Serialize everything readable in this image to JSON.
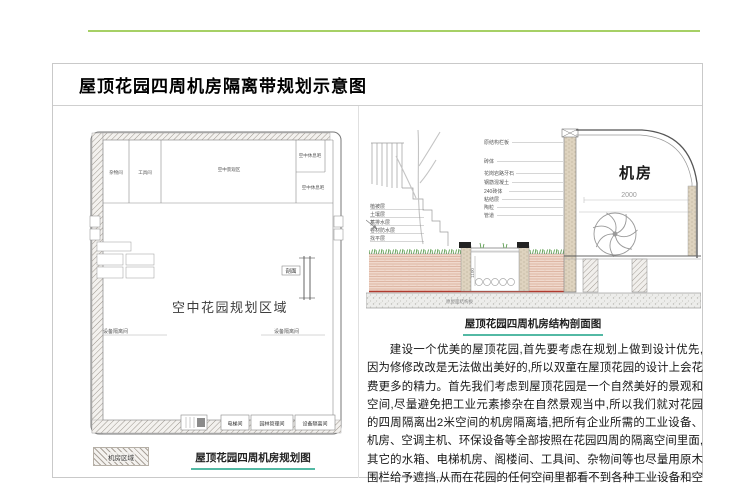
{
  "page": {
    "heading": "屋顶花园四周机房隔离带规划示意图"
  },
  "colors": {
    "accent_line": "#a6d065",
    "caption_underline": "#53b9a4"
  },
  "plan": {
    "caption": "屋顶花园四周机房规划图",
    "legend_label": "机房区域",
    "area_label": "空中花园规划区域",
    "section_mark_label": "剖面",
    "rooms": {
      "top1": "杂物间",
      "top2": "工具间",
      "top_center": "空中景观区",
      "right1": "空中休息吧",
      "right2": "空中休息吧",
      "iso_left": "设备隔离间",
      "iso_right": "设备隔离间",
      "bottom1": "电梯间",
      "bottom2": "园林管理间",
      "bottom3": "设备隔离间"
    }
  },
  "section": {
    "caption": "屋顶花园四周机房结构剖面图",
    "machine_room_label": "机房",
    "dim_width": "2000",
    "dim_depth": "1100",
    "slab_label": "原屋面结构板",
    "left_layers": [
      "植被层",
      "土壤层",
      "蓄排水层",
      "卷材防水层",
      "找平层"
    ],
    "wall_labels": [
      "原结构栏板",
      "砖体",
      "花岗岩路牙石",
      "钢筋混凝土",
      "240砖体",
      "粘结层",
      "陶粒",
      "管道"
    ]
  },
  "article": {
    "paragraph": "建设一个优美的屋顶花园,首先要考虑在规划上做到设计优先,因为修修改改是无法做出美好的,所以双童在屋顶花园的设计上会花费更多的精力。首先我们考虑到屋顶花园是一个自然美好的景观和空间,尽量避免把工业元素掺杂在自然景观当中,所以我们就对花园的四周隔离出2米空间的机房隔离墙,把所有企业所需的工业设备、机房、空调主机、环保设备等全部按照在花园四周的隔离空间里面,其它的水箱、电梯机房、阁楼间、工具间、杂物间等也尽量用原木围栏给予遮挡,从而在花园的任何空间里都看不到各种工业设备和空调主机,让屋顶花园的所有空间呈现出自然的和谐。"
  }
}
